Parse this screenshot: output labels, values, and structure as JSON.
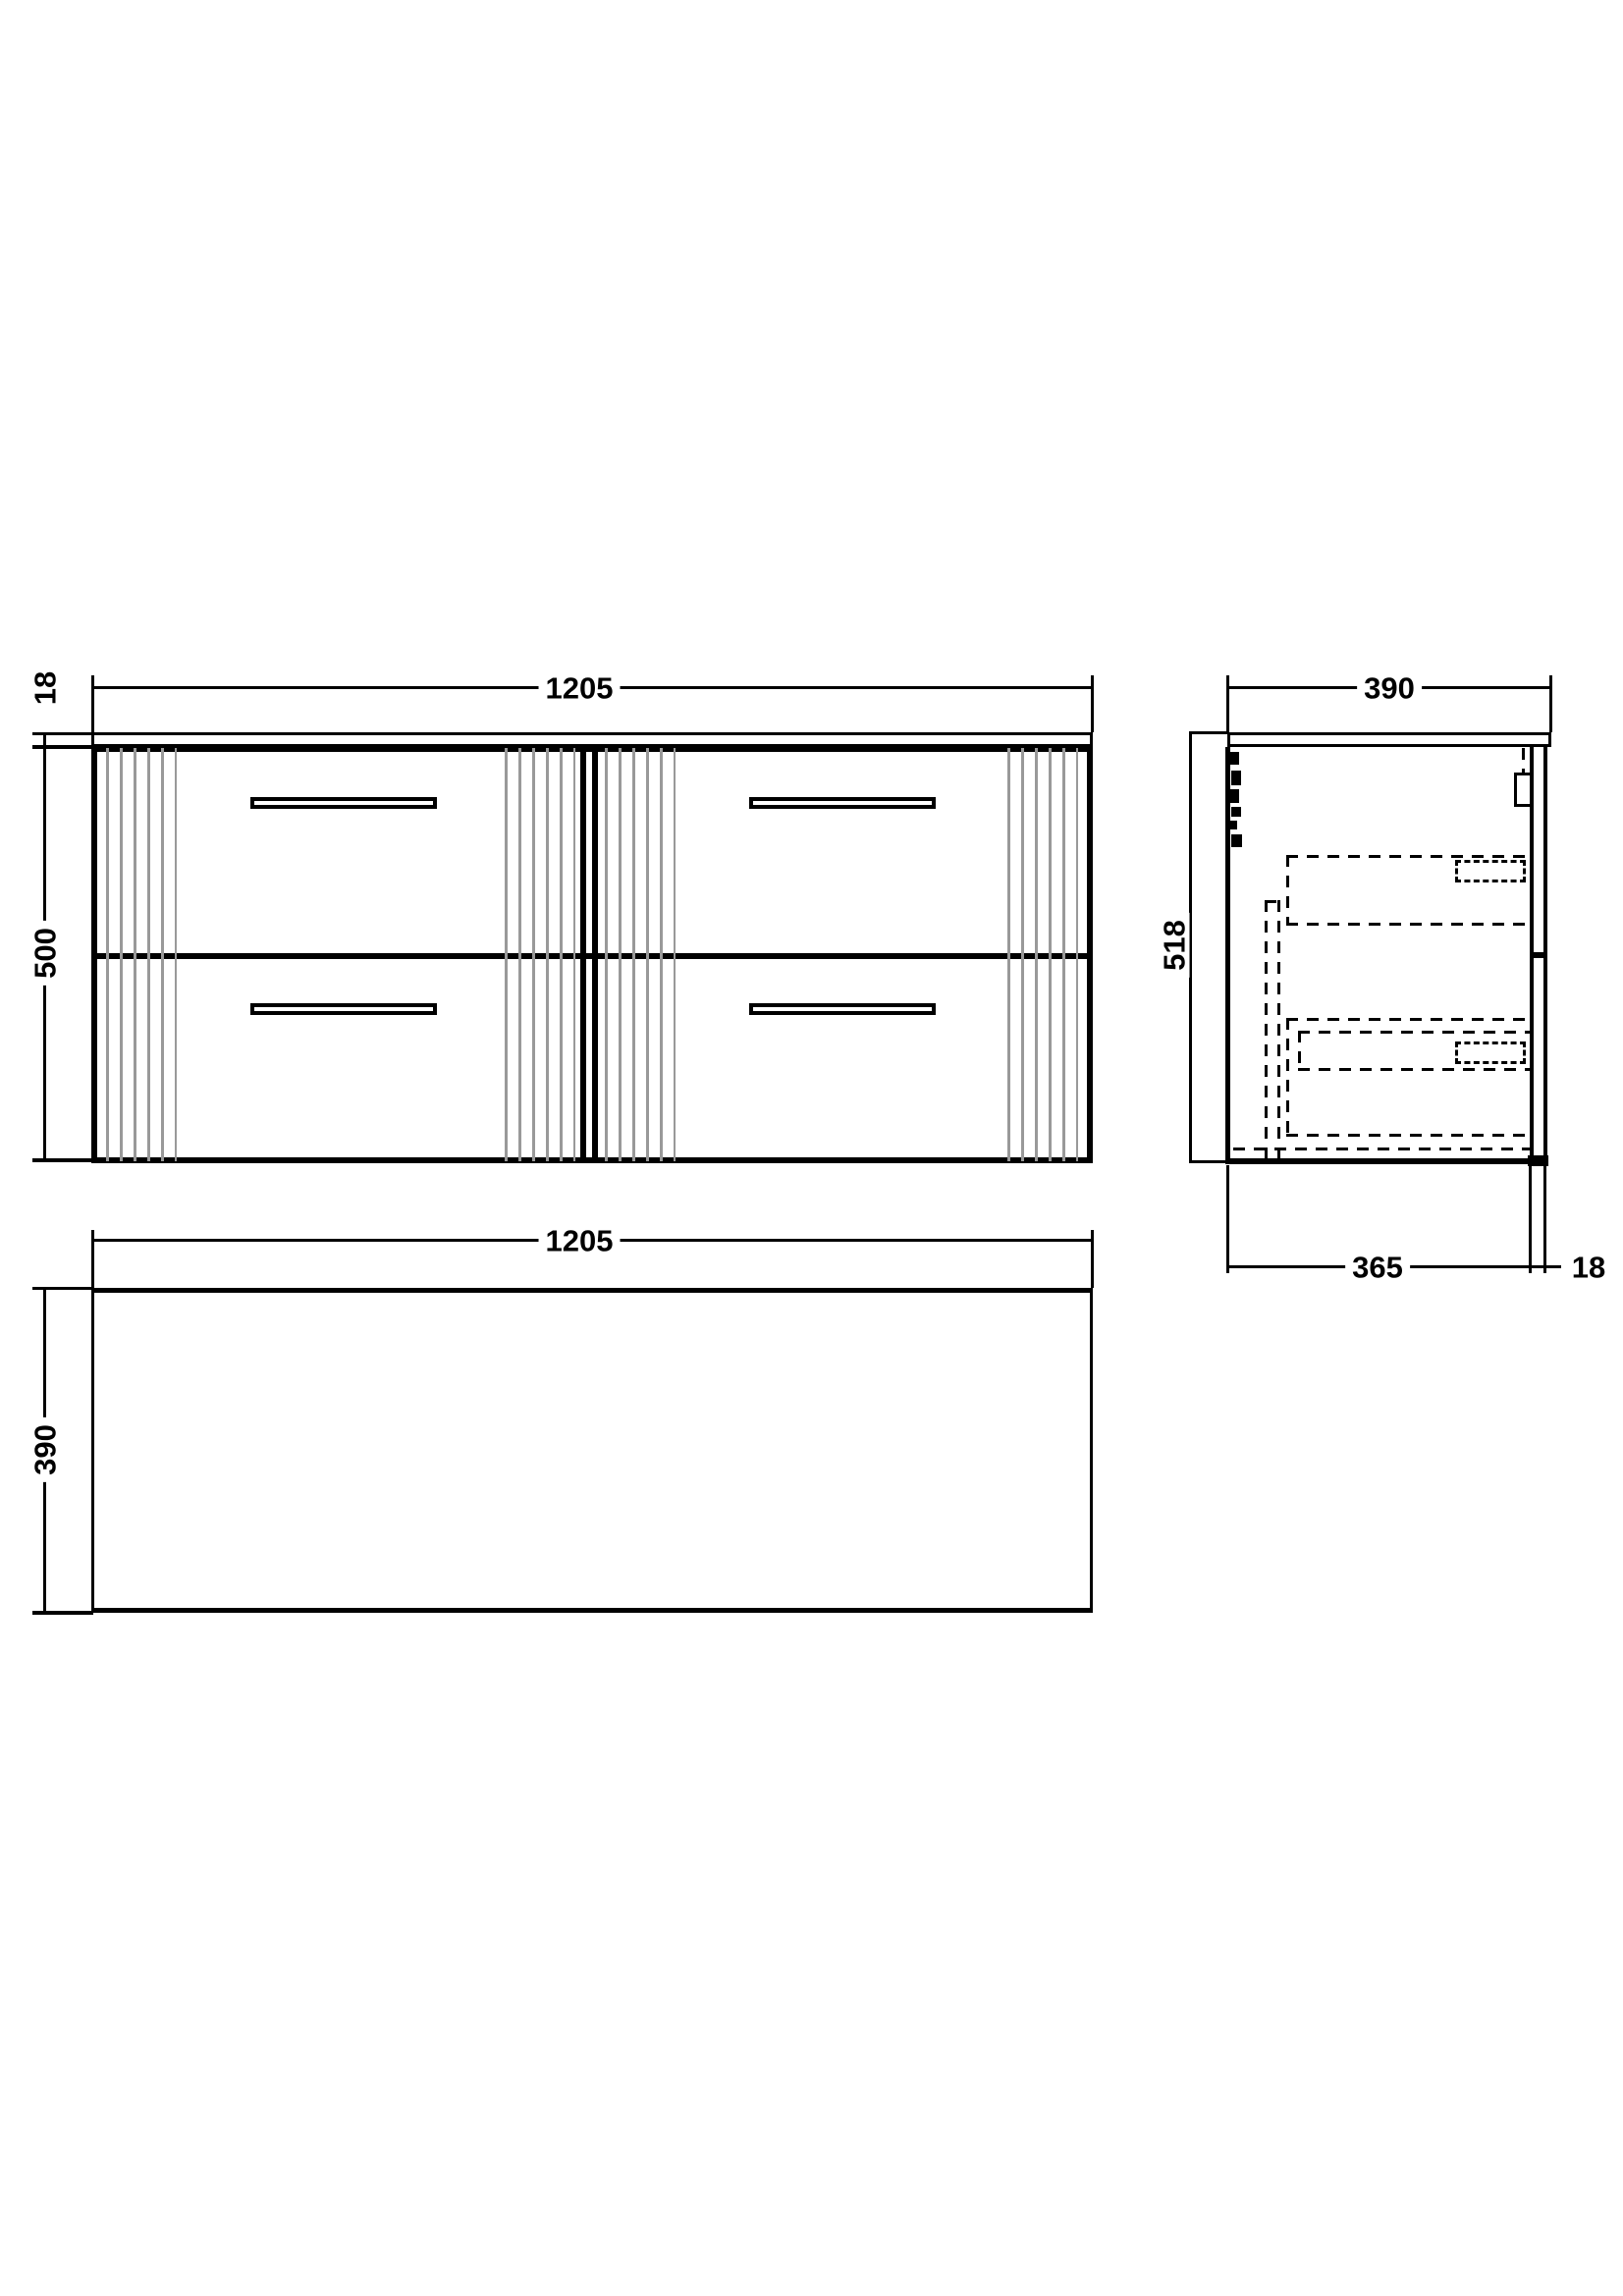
{
  "drawing": {
    "type": "technical-dimension-drawing",
    "subject": "wall-hung four-drawer vanity unit with countertop",
    "front_view": {
      "width_label": "1205",
      "counter_thickness_label": "18",
      "height_label": "500"
    },
    "side_view": {
      "width_label": "390",
      "height_label": "518",
      "depth_label": "365",
      "front_panel_label": "18"
    },
    "plan_view": {
      "width_label": "1205",
      "depth_label": "390"
    },
    "colors": {
      "line": "#000000",
      "flute": "#999999",
      "background": "#ffffff"
    }
  }
}
